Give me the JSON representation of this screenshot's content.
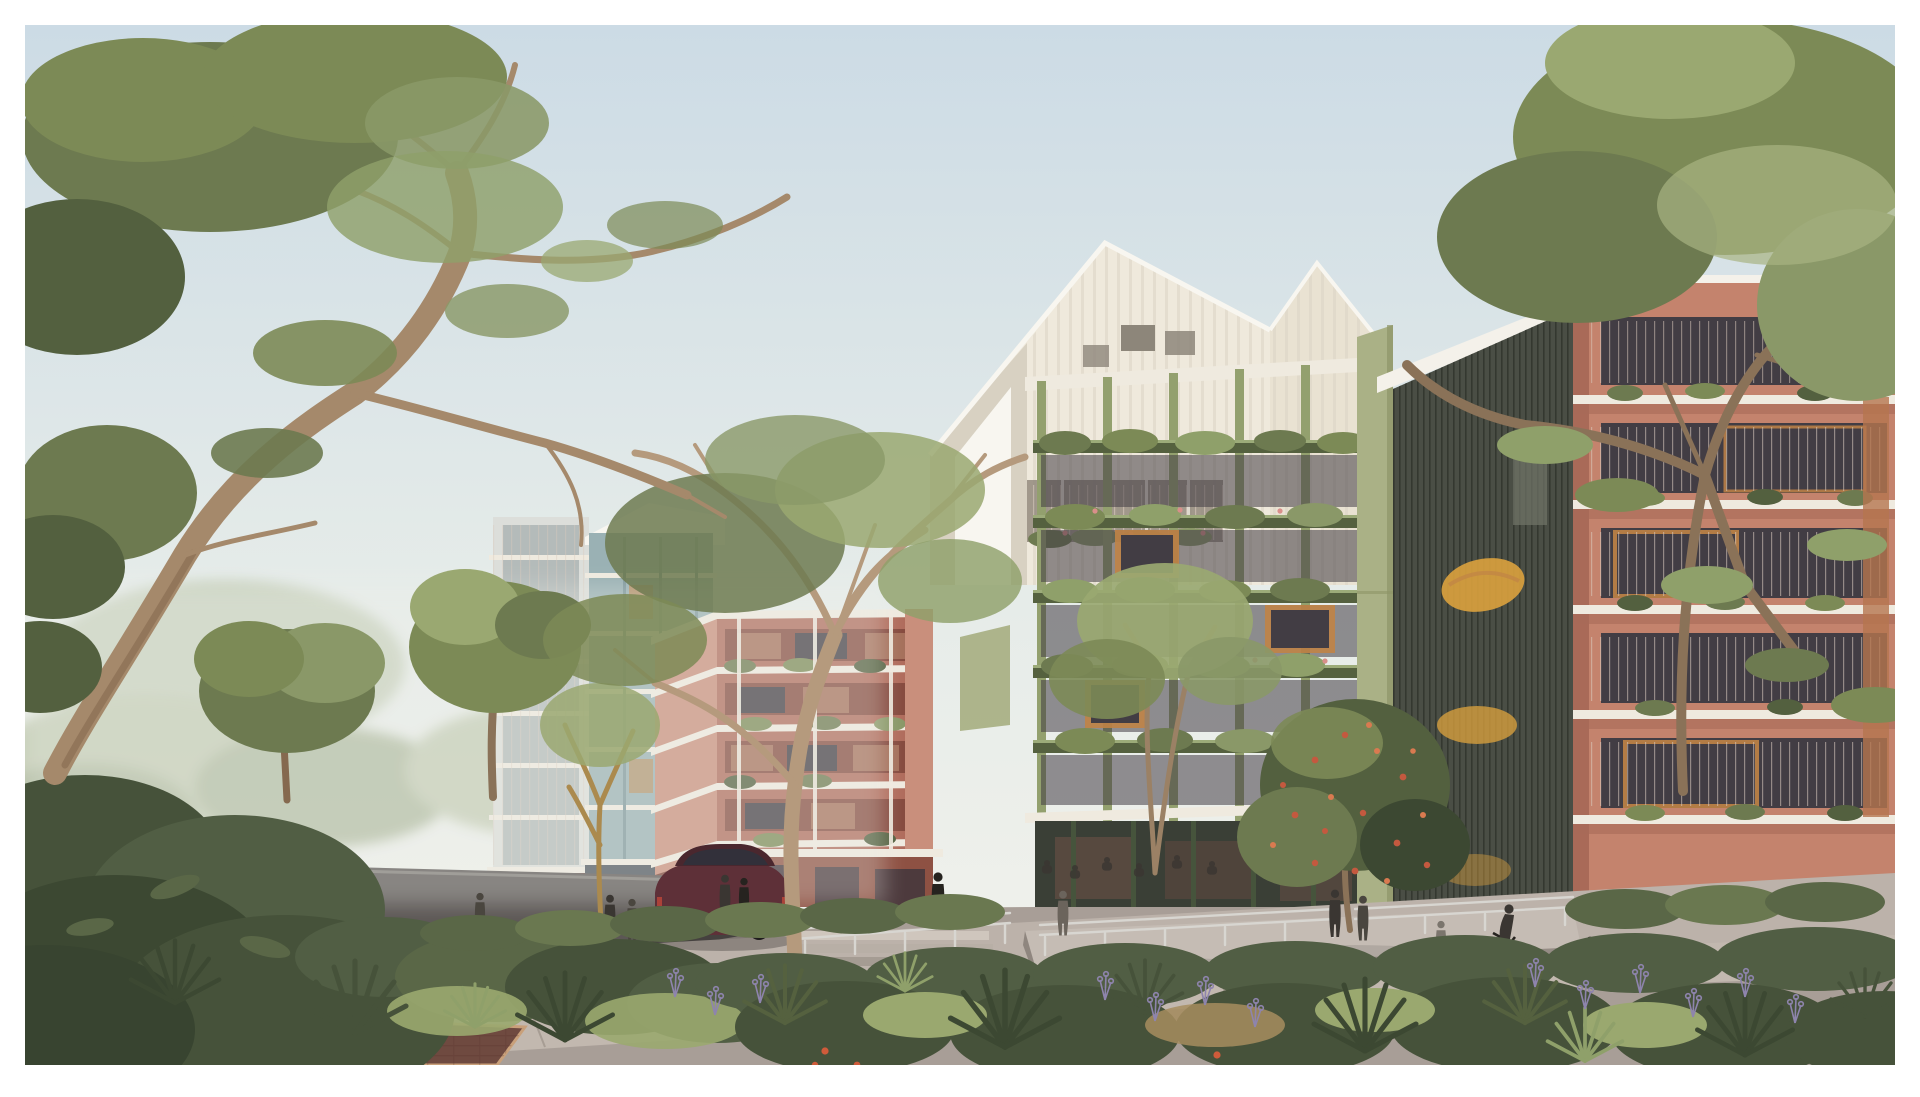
{
  "canvas": {
    "width_px": 1920,
    "height_px": 1097,
    "border_px": 25,
    "border_color": "#ffffff"
  },
  "scene": {
    "description": "Architectural render: tree-lined street with colourful mid-rise apartment buildings, ground-floor restaurants, landscaped verge, pedestrians, a cyclist and a parked car",
    "elements": [
      "sky",
      "background-treeline",
      "background-houses",
      "building-cream-gabled",
      "building-green-planted",
      "sage-panel",
      "mesh-screen-tower",
      "building-salmon-right",
      "building-grey-balconies",
      "building-teal",
      "building-terracotta",
      "ground-plane",
      "handrails",
      "car",
      "people",
      "street-trees",
      "flowering-tree",
      "foreground-planting",
      "tree-right-canopy",
      "tree-left-eucalyptus"
    ]
  },
  "palette": {
    "sky_top": "#ccdbe5",
    "sky_mid": "#e6ece9",
    "sky_bottom": "#f3f2ec",
    "haze": "#eef0ea",
    "bg_tree1": "#c2cbb2",
    "bg_tree2": "#aeb99e",
    "bg_tree3": "#b9c3a8",
    "house_wall": "#ece9e1",
    "house_wall2": "#e7e4dc",
    "house_roof": "#cfc9bd",
    "house_win": "#8d8a84",
    "fence": "#d9d6cd",
    "fol_dark": "#53603f",
    "fol_deep": "#46523a",
    "fol_darker": "#3c4832",
    "fol_mid": "#6d7a50",
    "fol_mid2": "#7c8a56",
    "fol_light": "#8a9868",
    "fol_lighter": "#9aa871",
    "fol_pale": "#a8b381",
    "fol_sage": "#8fa06a",
    "grass_light": "#9aa86f",
    "grass_dry": "#a78d5f",
    "trunk": "#a5896b",
    "trunk_dark": "#85694f",
    "trunk_warm": "#b59a7d",
    "trunk_grey": "#8a7258",
    "trunk_slender": "#9b8165",
    "trunk_gold": "#ab8a4e",
    "cream": "#efe9dc",
    "cream_shade": "#d8d1c2",
    "cream2": "#e9e2d2",
    "ridge": "#f8f6f0",
    "attic_win": "#8d867a",
    "recess": "#8b8275",
    "grey_wall": "#dcdeda",
    "grey_glass": "#aab2b2",
    "teal_wall": "#a9bfc2",
    "teal_mullion": "#7e979c",
    "teal_base": "#4e565e",
    "teal_glass": "#6d7581",
    "terra_left": "#c98f7c",
    "terra_front": "#b06c5c",
    "terra_void": "#7f453a",
    "terra_ground": "#8e5143",
    "terra_ground_dark": "#7c4237",
    "terra_inner": "#a5705b",
    "slab_white": "#efeadf",
    "green_col": "#93a06e",
    "green_slab": "#55613f",
    "green_slab_lit": "#9cab79",
    "rest_glass": "#3a3f36",
    "rest_mullion": "#46543c",
    "warm_glow": "#6a5046",
    "warm_glow2": "#5d4840",
    "sage": "#aab186",
    "sage_edge": "#8d9468",
    "mesh": "#4a4e45",
    "mesh_line": "#30342c",
    "parapet": "#f4f1ea",
    "stair_yellow": "#dfa43e",
    "slot": "#707568",
    "salmon": "#c4836d",
    "salmon_shade": "#a96a58",
    "void_dark": "#423d44",
    "win_frame": "#c08346",
    "rail_line": "#d9c9bd",
    "timber": "#b5764f",
    "brick": "#7e3d31",
    "brick_dark": "#55302a",
    "brick_darker": "#512d28",
    "awning_orange": "#d2602f",
    "crowd_warm": "#6a4a3c",
    "crowd_warm2": "#65463a",
    "lamp_glow": "#d8a05f",
    "pier_glass": "#cfd2cc",
    "ground": "#a89e97",
    "road": "#5c5755",
    "road_line": "#8f8a85",
    "walk": "#c2b8af",
    "walk_edge": "#a79d94",
    "plaza": "#bcb2aa",
    "ramp_top": "#c5bcb4",
    "ramp_face": "#958c85",
    "ramp_side": "#8f867f",
    "step1": "#cfc6bd",
    "step2": "#b8afa6",
    "step3": "#a59c93",
    "paver": "#6f4a40",
    "paver_edge": "#c9a07a",
    "rail_metal": "#d8d6d1",
    "planter_dark": "#515e44",
    "hedge": "#5a6747",
    "hedge2": "#6a7850",
    "shrub_darkest": "#384430",
    "lavender": "#9b90bb",
    "lavender_stem": "#8e84ad",
    "blossom": "#c4593f",
    "blossom_lt": "#d97a50",
    "flower_pink": "#d98f8a",
    "poppy": "#cf5b3a",
    "people_dark": "#3a3632",
    "people_darker": "#26231f",
    "people_mid": "#4a463f",
    "people_light": "#6b645c",
    "diner": "#2e2522",
    "car_body": "#5e3038",
    "car_roof": "#4a272e",
    "car_glass": "#32303a",
    "tyre": "#1e1c1c",
    "taillight": "#b8453a",
    "glass_entry": "#b9bdb8",
    "yellow_wall": "#d8a348",
    "shadow": "#000000"
  }
}
